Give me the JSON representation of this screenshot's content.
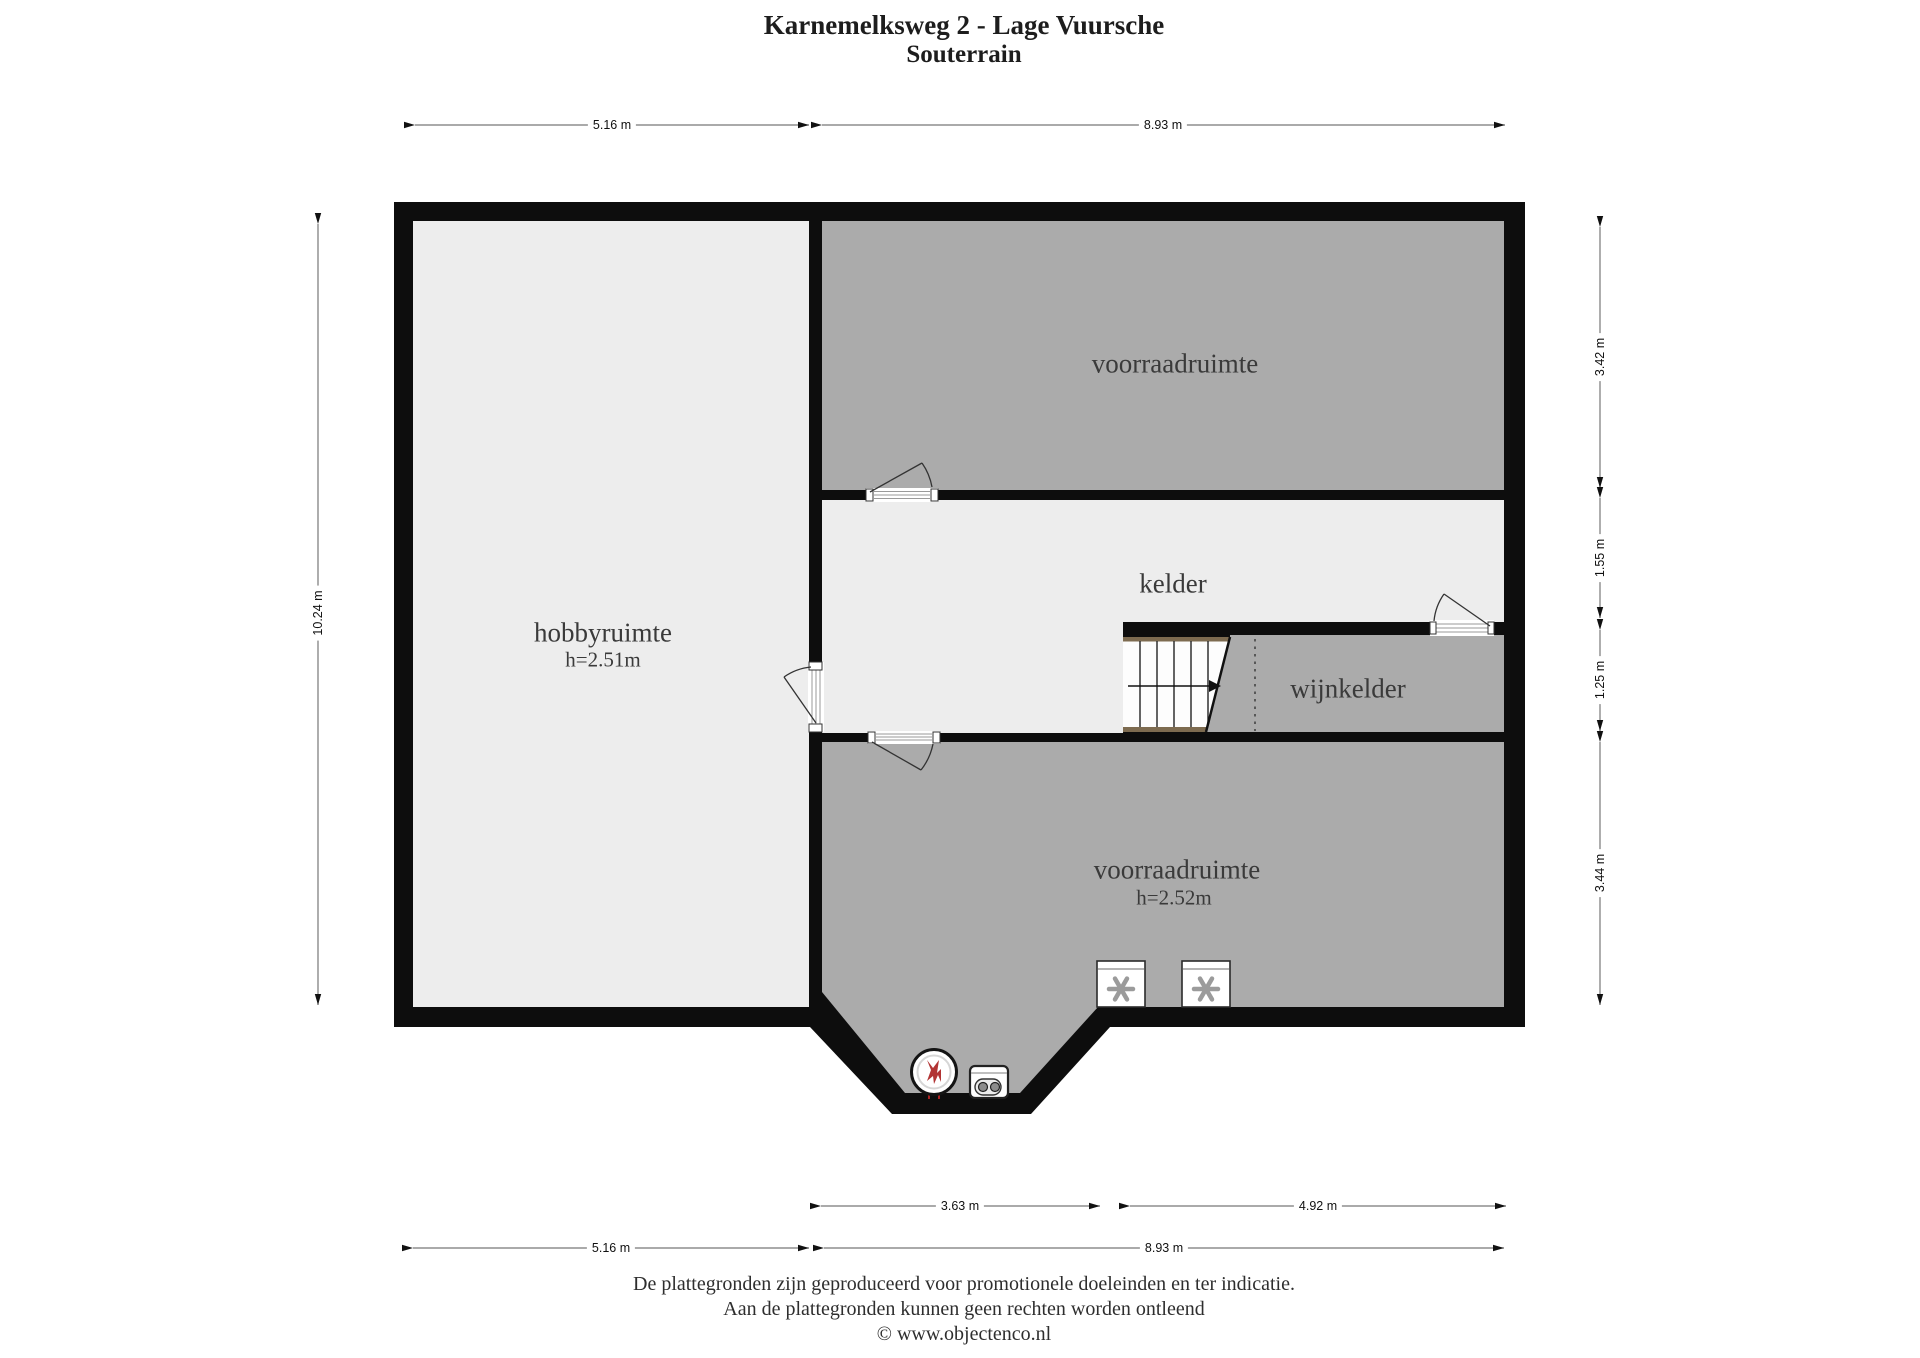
{
  "title": {
    "line1": "Karnemelksweg 2 - Lage Vuursche",
    "line2": "Souterrain"
  },
  "rooms": {
    "hobbyruimte": {
      "label": "hobbyruimte",
      "height": "h=2.51m"
    },
    "voorraadruimte_top": {
      "label": "voorraadruimte"
    },
    "kelder": {
      "label": "kelder"
    },
    "wijnkelder": {
      "label": "wijnkelder"
    },
    "voorraadruimte_bottom": {
      "label": "voorraadruimte",
      "height": "h=2.52m"
    }
  },
  "dimensions": {
    "top_left": "5.16 m",
    "top_right": "8.93 m",
    "left_total": "10.24 m",
    "right_1": "3.42 m",
    "right_2": "1.55 m",
    "right_3": "1.25 m",
    "right_4": "3.44 m",
    "bottom_inner_left": "3.63 m",
    "bottom_inner_right": "4.92 m",
    "bottom_outer_left": "5.16 m",
    "bottom_outer_right": "8.93 m"
  },
  "footer": {
    "line1": "De plattegronden zijn geproduceerd voor promotionele doeleinden en ter indicatie.",
    "line2": "Aan de plattegronden kunnen geen rechten worden ontleend",
    "line3": "© www.objectenco.nl"
  },
  "colors": {
    "wall": "#0d0d0d",
    "room_light": "#ededed",
    "room_dark": "#ababab",
    "stair_wood": "#7d6b50",
    "boiler_flame_red": "#b23434"
  }
}
